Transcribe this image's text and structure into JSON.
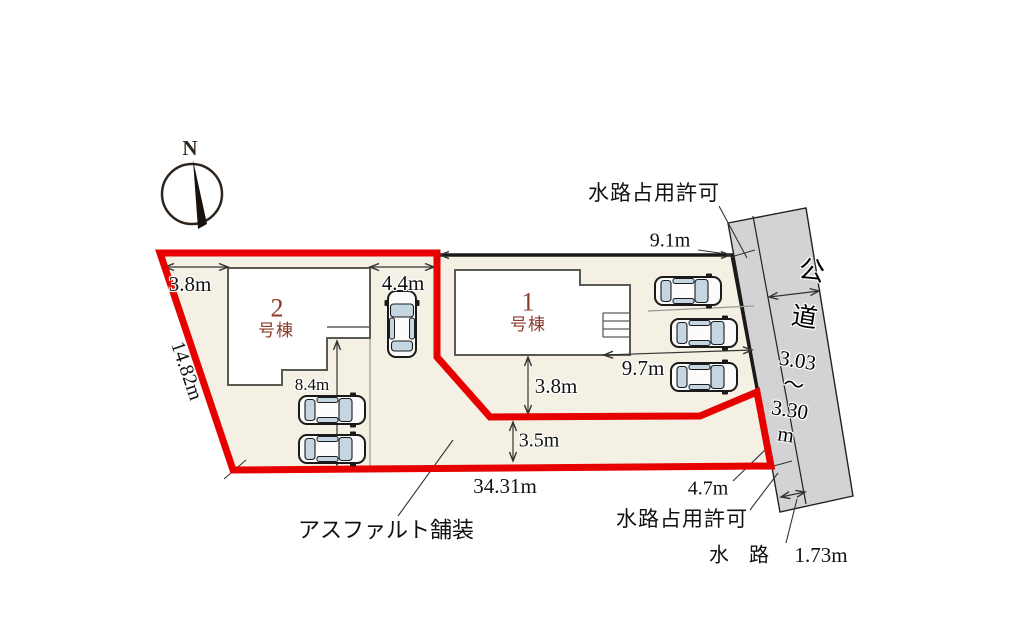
{
  "compass": {
    "north_label": "N"
  },
  "plot": {
    "buildings": {
      "b1_number": "1",
      "b1_suffix": "号棟",
      "b2_number": "2",
      "b2_suffix": "号棟"
    },
    "surface_label": "アスファルト舗装"
  },
  "dimensions": {
    "west_top": "3.8m",
    "parking_bay": "4.4m",
    "west_edge": "14.82m",
    "driveway": "8.4m",
    "north_edge": "9.1m",
    "south_setback_b1": "3.8m",
    "east_setback_b1": "9.7m",
    "access_strip": "3.5m",
    "south_edge": "34.31m",
    "road_frontage": "4.7m",
    "waterway_width": "1.73m",
    "road_width_1": "3.03",
    "road_width_2": "〜",
    "road_width_3": "3.30",
    "road_width_4": "m"
  },
  "annotations": {
    "waterway_permit_top": "水路占用許可",
    "waterway_permit_bottom": "水路占用許可",
    "waterway_name": "水　路",
    "road_name_1": "公",
    "road_name_2": "道"
  },
  "colors": {
    "plot_fill": "#f4f0e3",
    "road_fill": "#d3d3d5",
    "boundary_red": "#e60000",
    "building_label": "#8b3a2a",
    "car_window": "#c3d6e2"
  }
}
